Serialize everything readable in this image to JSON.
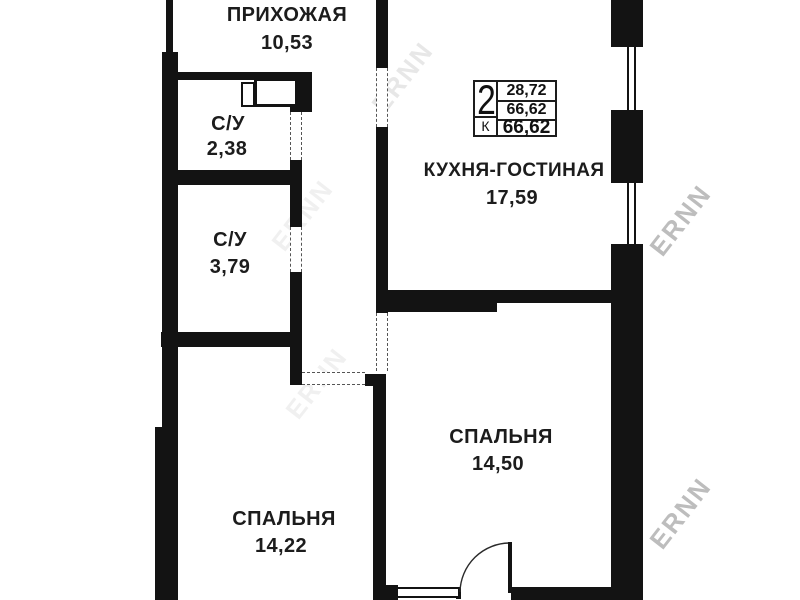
{
  "plan": {
    "wall_color": "#131313",
    "rooms": [
      {
        "id": "hallway",
        "label": "ПРИХОЖАЯ",
        "area": "10,53"
      },
      {
        "id": "bathroom-small",
        "label": "С/У",
        "area": "2,38"
      },
      {
        "id": "bathroom-large",
        "label": "С/У",
        "area": "3,79"
      },
      {
        "id": "kitchen-living",
        "label": "КУХНЯ-ГОСТИНАЯ",
        "area": "17,59"
      },
      {
        "id": "bedroom-right",
        "label": "СПАЛЬНЯ",
        "area": "14,50"
      },
      {
        "id": "bedroom-left",
        "label": "СПАЛЬНЯ",
        "area": "14,22"
      }
    ],
    "info_box": {
      "rooms_count": "2",
      "coefficient_label": "К",
      "values": [
        "28,72",
        "66,62",
        "66,62"
      ]
    },
    "watermark": {
      "text": "ERNN"
    }
  }
}
